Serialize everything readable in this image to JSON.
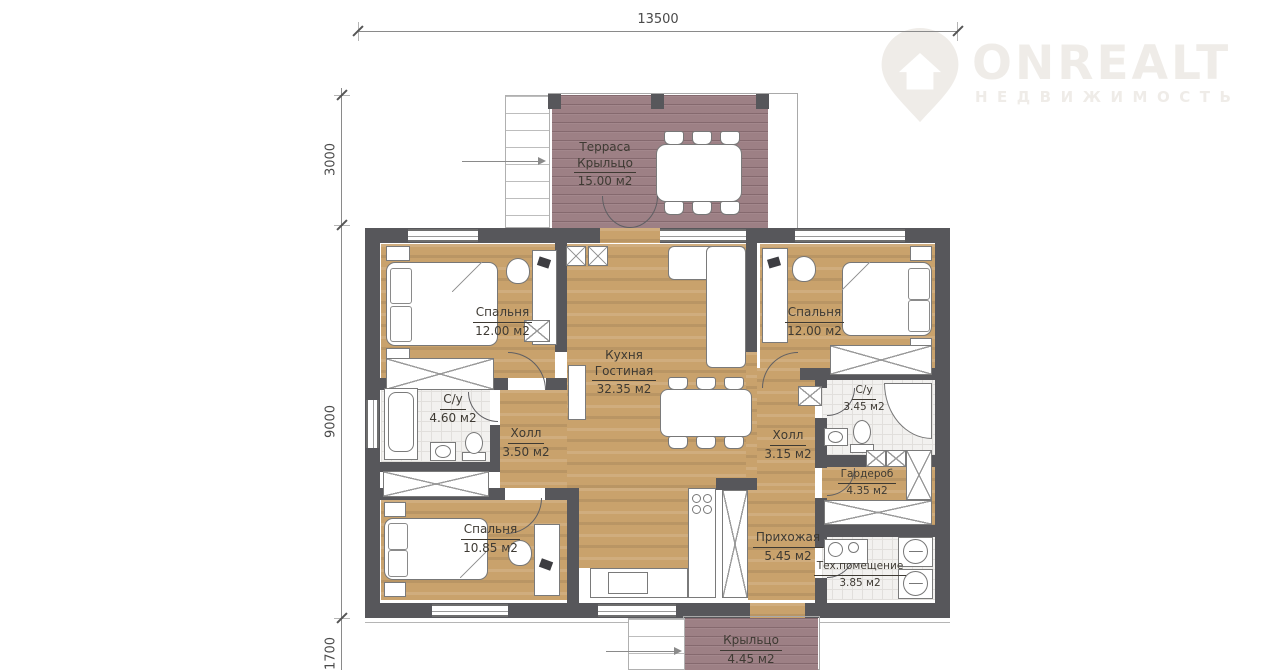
{
  "logo": {
    "title": "ONREALT",
    "subtitle": "НЕДВИЖИМОСТЬ"
  },
  "dimensions": {
    "top": "13500",
    "left_top": "3000",
    "left_middle": "9000",
    "left_bottom": "1700"
  },
  "rooms": {
    "terrace": {
      "name": "Терраса",
      "name2": "Крыльцо",
      "area": "15.00 м2"
    },
    "bedroom_left": {
      "name": "Спальня",
      "area": "12.00 м2"
    },
    "bedroom_right": {
      "name": "Спальня",
      "area": "12.00 м2"
    },
    "kitchen": {
      "name": "Кухня",
      "name2": "Гостиная",
      "area": "32.35 м2"
    },
    "bath_left": {
      "name": "С/у",
      "area": "4.60 м2"
    },
    "hall_left": {
      "name": "Холл",
      "area": "3.50 м2"
    },
    "hall_right": {
      "name": "Холл",
      "area": "3.15 м2"
    },
    "bath_right": {
      "name": "С/у",
      "area": "3.45 м2"
    },
    "wardrobe_room": {
      "name": "Гардероб",
      "area": "4.35 м2"
    },
    "bedroom_bottom": {
      "name": "Спальня",
      "area": "10.85 м2"
    },
    "hallway": {
      "name": "Прихожая",
      "area": "5.45 м2"
    },
    "tech": {
      "name": "Тех.помещение",
      "area": "3.85 м2"
    },
    "porch": {
      "name": "Крыльцо",
      "area": "4.45 м2"
    }
  },
  "colors": {
    "wall": "#57575b",
    "wood": "#c9a26c",
    "deck": "#9d8085",
    "label": "#3e3a33"
  }
}
